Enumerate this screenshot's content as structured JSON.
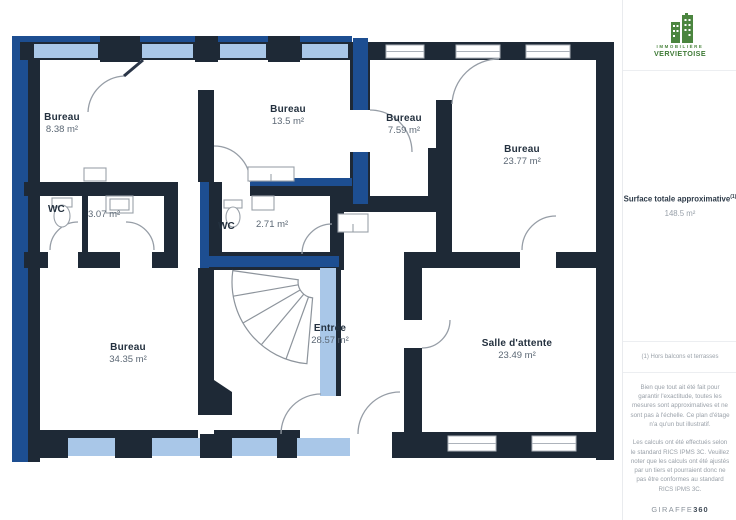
{
  "plan": {
    "rooms": [
      {
        "name": "Bureau",
        "area": "8.38 m²"
      },
      {
        "name": "Bureau",
        "area": "13.5 m²"
      },
      {
        "name": "Bureau",
        "area": "7.59 m²"
      },
      {
        "name": "Bureau",
        "area": "23.77 m²"
      },
      {
        "name": "WC",
        "area": "3.07 m²"
      },
      {
        "name": "WC",
        "area": "2.71 m²"
      },
      {
        "name": "Bureau",
        "area": "34.35 m²"
      },
      {
        "name": "Entrée",
        "area": "28.57 m²"
      },
      {
        "name": "Salle d'attente",
        "area": "23.49 m²"
      }
    ],
    "colors": {
      "wall_dark": "#1e2936",
      "highlight_blue": "#1d4e91",
      "window_light_blue": "#a9c7e8",
      "room_white": "#ffffff",
      "door_arc_gray": "#969da6"
    }
  },
  "sidebar": {
    "logo": {
      "line1": "IMMOBILIÈRE",
      "line2": "VERVIETOISE",
      "color": "#3f7a36"
    },
    "surface": {
      "label": "Surface totale approximative",
      "superscript": "(1)",
      "value": "148.5 m²"
    },
    "footnote": "(1) Hors balcons et terrasses",
    "disclaimer1": "Bien que tout ait été fait pour garantir l'exactitude, toutes les mesures sont approximatives et ne sont pas à l'échelle. Ce plan d'étage n'a qu'un but illustratif.",
    "disclaimer2": "Les calculs ont été effectués selon le standard RICS IPMS 3C. Veuillez noter que les calculs ont été ajustés par un tiers et pourraient donc ne pas être conformes au standard RICS IPMS 3C.",
    "brand": {
      "name": "GIRAFFE",
      "suffix": "360"
    }
  }
}
